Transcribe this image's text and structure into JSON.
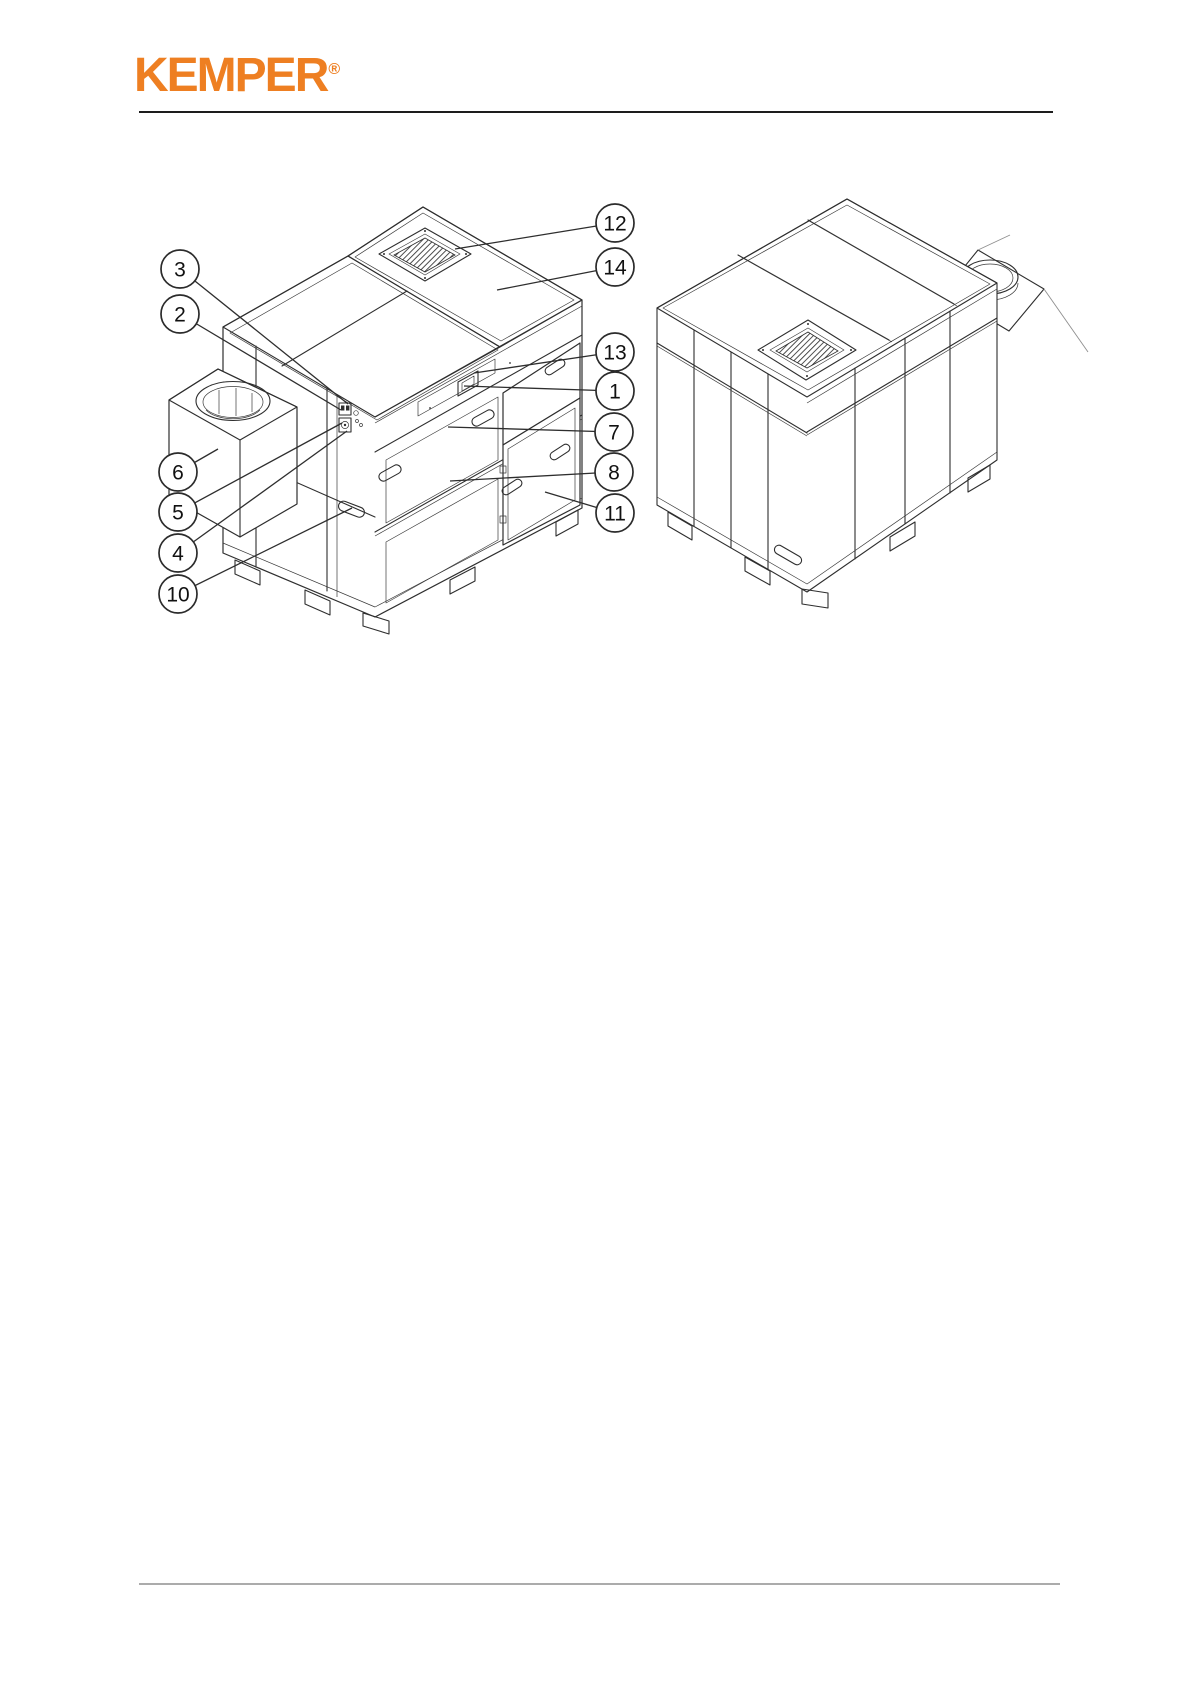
{
  "header": {
    "logo_text": "KEMPER",
    "trademark_symbol": "®",
    "brand_color": "#EE7F22"
  },
  "figure": {
    "line_color": "#2e2e2e",
    "callout_style": {
      "radius": 19,
      "stroke": "#2b2b2b",
      "number_color": "#111111"
    },
    "callouts": [
      {
        "number": "12",
        "cx": 615,
        "cy": 223,
        "tx": 455,
        "ty": 249
      },
      {
        "number": "14",
        "cx": 615,
        "cy": 267,
        "tx": 497,
        "ty": 290
      },
      {
        "number": "13",
        "cx": 615,
        "cy": 352,
        "tx": 474,
        "ty": 373
      },
      {
        "number": "1",
        "cx": 615,
        "cy": 391,
        "tx": 464,
        "ty": 386
      },
      {
        "number": "7",
        "cx": 614,
        "cy": 432,
        "tx": 448,
        "ty": 427
      },
      {
        "number": "8",
        "cx": 614,
        "cy": 472,
        "tx": 450,
        "ty": 481
      },
      {
        "number": "11",
        "cx": 615,
        "cy": 513,
        "tx": 545,
        "ty": 492
      },
      {
        "number": "3",
        "cx": 180,
        "cy": 269,
        "tx": 348,
        "ty": 404
      },
      {
        "number": "2",
        "cx": 180,
        "cy": 314,
        "tx": 341,
        "ty": 410
      },
      {
        "number": "6",
        "cx": 178,
        "cy": 472,
        "tx": 218,
        "ty": 449
      },
      {
        "number": "5",
        "cx": 178,
        "cy": 512,
        "tx": 342,
        "ty": 423
      },
      {
        "number": "4",
        "cx": 178,
        "cy": 553,
        "tx": 347,
        "ty": 431
      },
      {
        "number": "10",
        "cx": 178,
        "cy": 594,
        "tx": 352,
        "ty": 508
      }
    ]
  }
}
